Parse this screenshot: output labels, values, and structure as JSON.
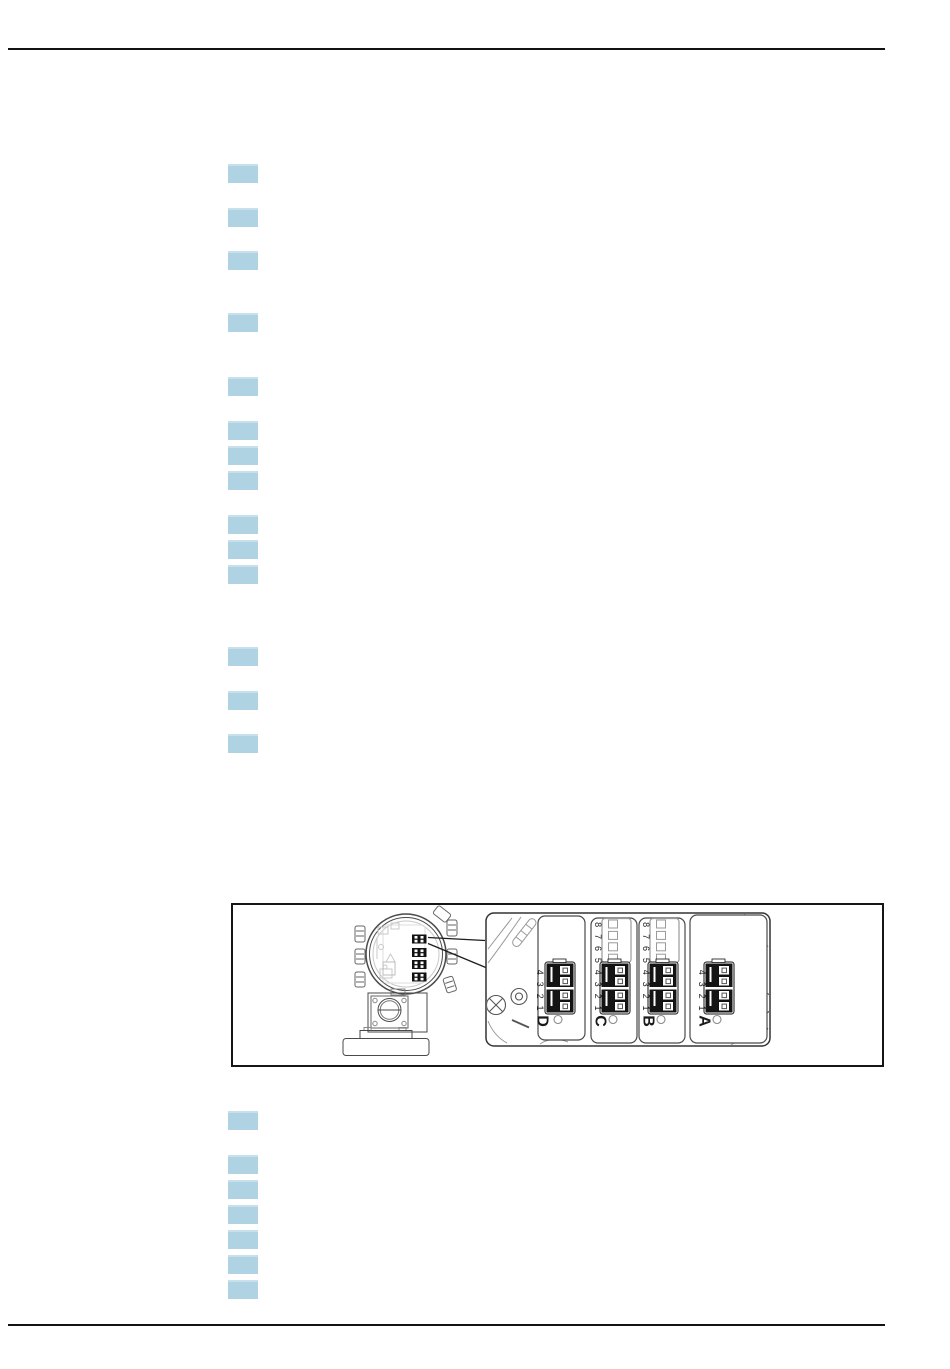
{
  "page": {
    "background": "#ffffff",
    "rule_color": "#121212"
  },
  "highlight": {
    "color": "#b0d3e4",
    "x": 228,
    "width": 30,
    "height": 19,
    "y_positions": [
      164,
      208,
      251,
      313,
      377,
      421,
      446,
      471,
      515,
      540,
      565,
      647,
      691,
      734,
      1111,
      1155,
      1180,
      1205,
      1230,
      1255,
      1280
    ]
  },
  "figure": {
    "border_color": "#161616",
    "sections": [
      {
        "label": "D",
        "pins": [
          "1",
          "2",
          "3",
          "4"
        ],
        "empty_socket": false
      },
      {
        "label": "C",
        "pins": [
          "1",
          "2",
          "3",
          "4",
          "5",
          "6",
          "7",
          "8"
        ],
        "empty_socket": true
      },
      {
        "label": "B",
        "pins": [
          "1",
          "2",
          "3",
          "4",
          "5",
          "6",
          "7",
          "8"
        ],
        "empty_socket": true
      },
      {
        "label": "A",
        "pins": [
          "1",
          "2",
          "3",
          "4"
        ],
        "empty_socket": false
      }
    ]
  }
}
